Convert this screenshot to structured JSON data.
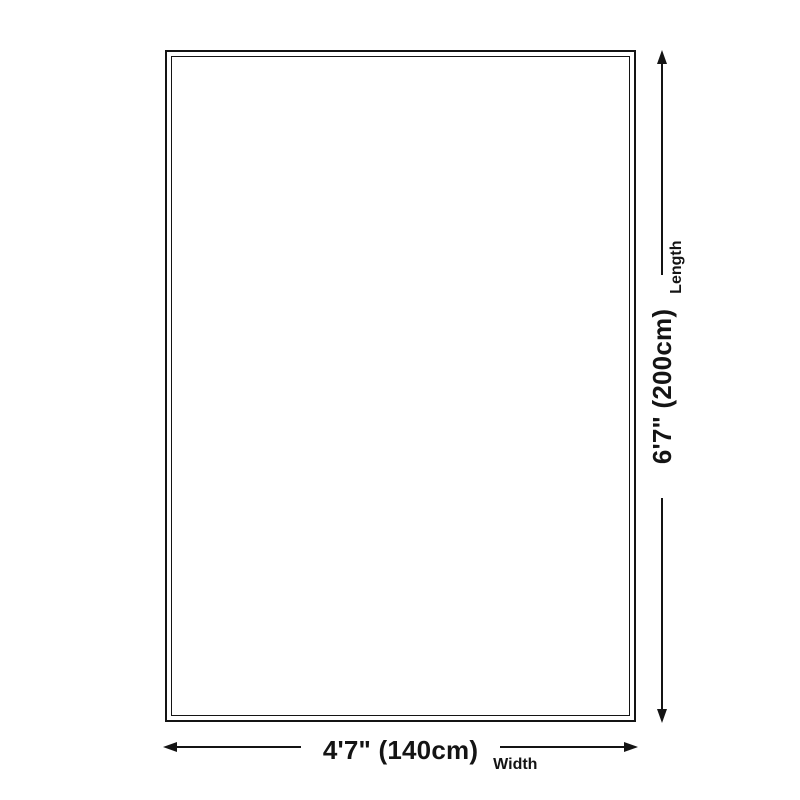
{
  "diagram": {
    "type": "product-dimension-diagram",
    "shape": "rectangle",
    "background_color": "#ffffff",
    "line_color": "#141414",
    "width_dimension": {
      "value": "4'7\" (140cm)",
      "label": "Width"
    },
    "length_dimension": {
      "value": "6'7\" (200cm)",
      "label": "Length"
    }
  }
}
